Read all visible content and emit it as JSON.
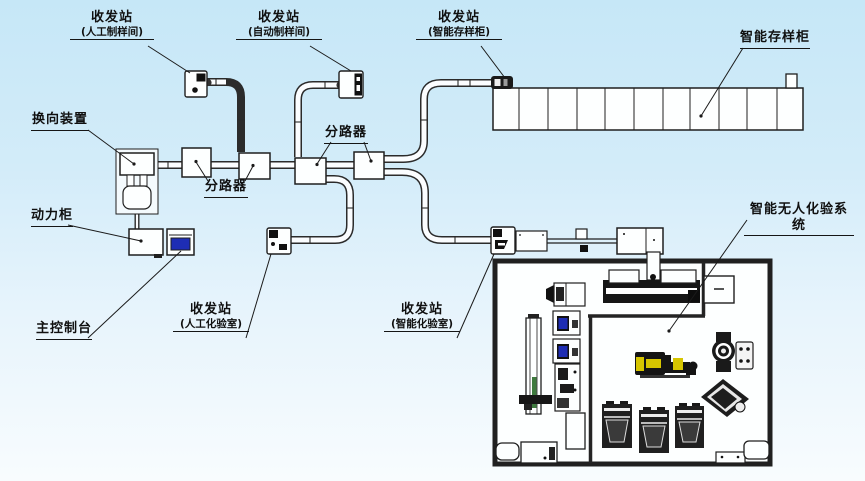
{
  "labels": {
    "station_manual_prep": {
      "title": "收发站",
      "sub": "(人工制样间)"
    },
    "station_auto_prep": {
      "title": "收发站",
      "sub": "(自动制样间)"
    },
    "station_storage": {
      "title": "收发站",
      "sub": "(智能存样柜)"
    },
    "smart_storage_cabinet": "智能存样柜",
    "diverter": "换向装置",
    "splitter_left": "分路器",
    "splitter_right": "分路器",
    "power_cabinet": "动力柜",
    "main_console": "主控制台",
    "station_manual_lab": {
      "title": "收发站",
      "sub": "(人工化验室)"
    },
    "station_smart_lab": {
      "title": "收发站",
      "sub": "(智能化验室)"
    },
    "smart_unmanned_lab": "智能无人化验系统"
  },
  "storage_cabinet": {
    "cells": 11
  },
  "colors": {
    "line": "#1f1f1f",
    "screen_blue": "#1e2db4",
    "robot_yellow": "#d6c500",
    "rail_green": "#3e7a3e",
    "background_top": "#c6e7f7",
    "background_bottom": "#f8fcfe"
  }
}
